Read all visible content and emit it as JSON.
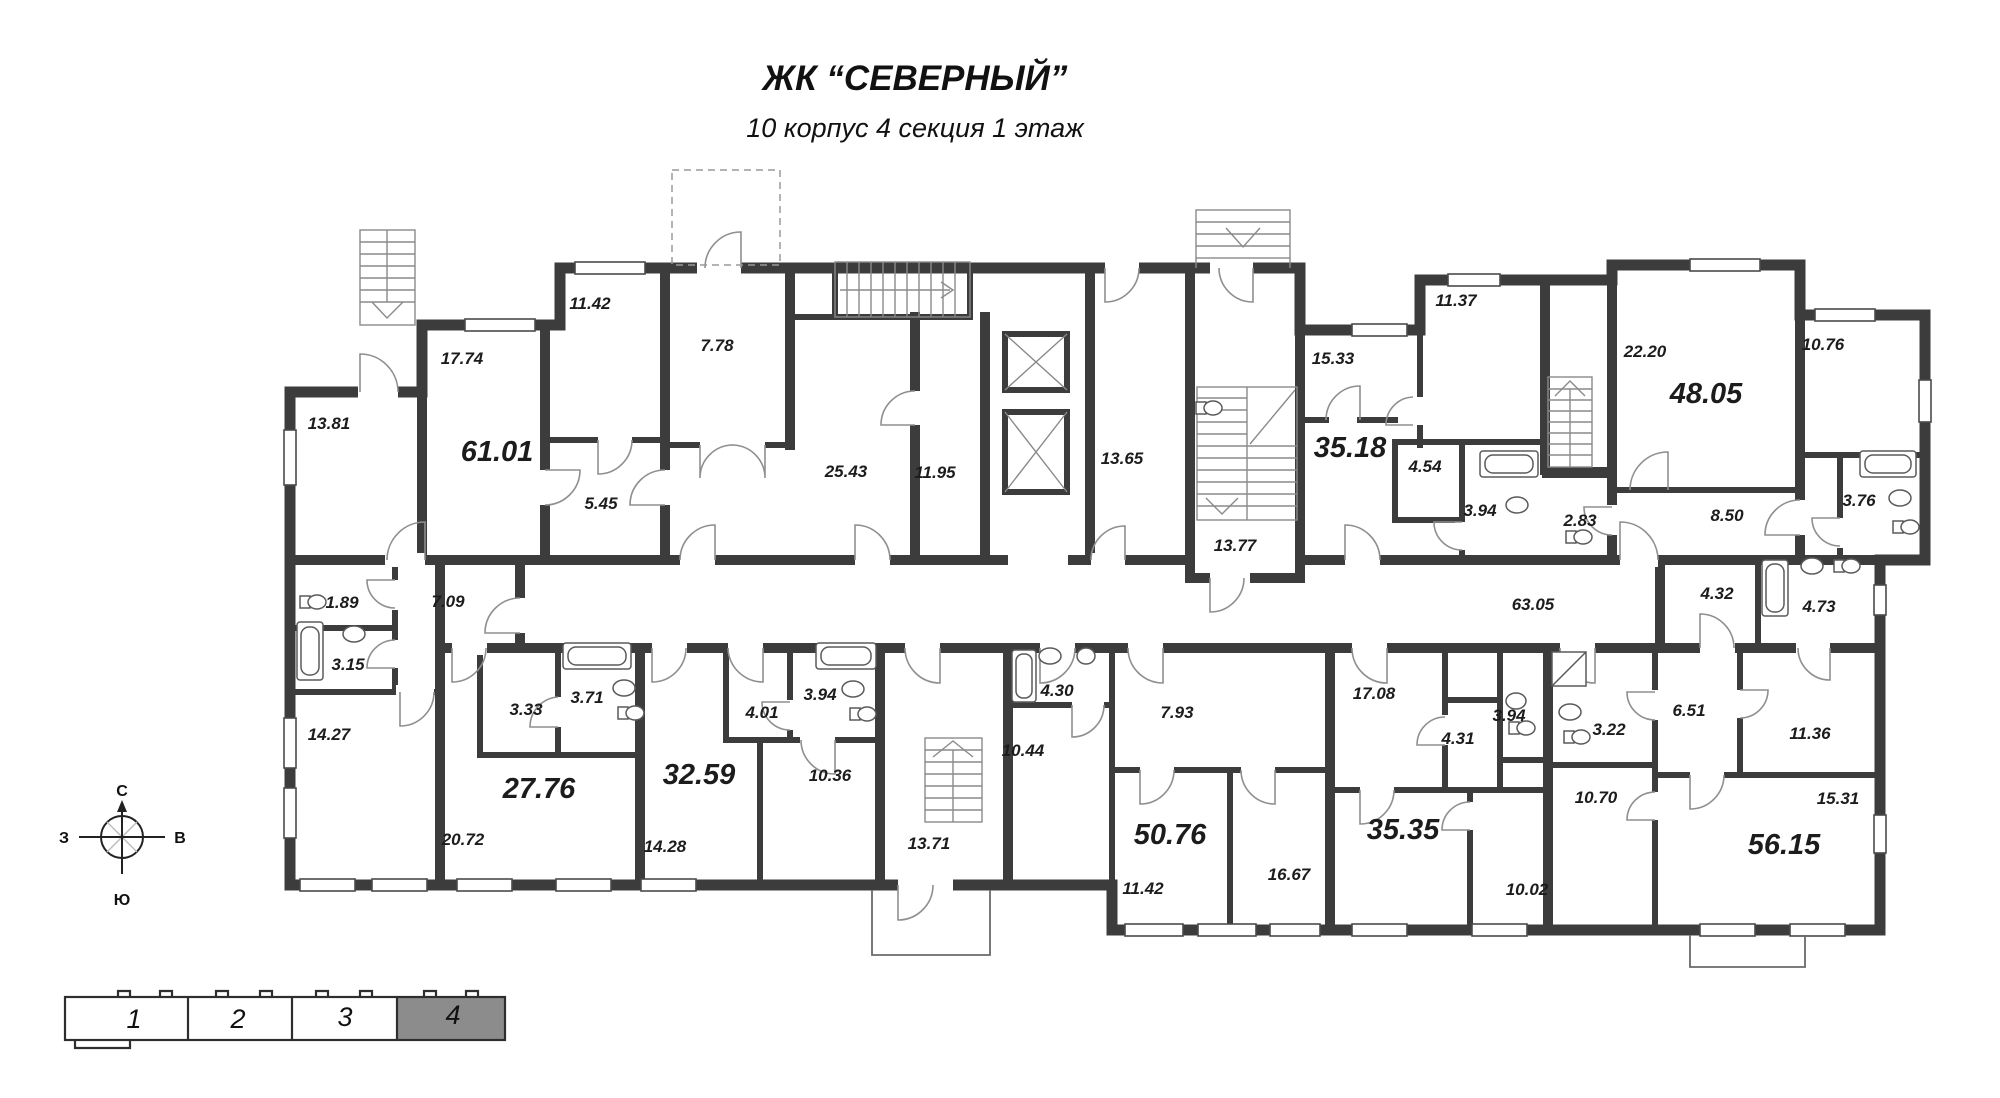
{
  "title": {
    "line1": "ЖК “СЕВЕРНЫЙ”",
    "line2": "10 корпус 4 секция 1 этаж"
  },
  "compass": {
    "north": "С",
    "south": "Ю",
    "west": "З",
    "east": "В"
  },
  "key_plan": {
    "sections": [
      {
        "label": "1",
        "highlighted": false
      },
      {
        "label": "2",
        "highlighted": false
      },
      {
        "label": "3",
        "highlighted": false
      },
      {
        "label": "4",
        "highlighted": true
      }
    ]
  },
  "colors": {
    "wall": "#3c3c3c",
    "highlight_section": "#8c8c8c"
  },
  "rooms": [
    {
      "area": "13.81"
    },
    {
      "area": "17.74"
    },
    {
      "area": "61.01"
    },
    {
      "area": "11.42"
    },
    {
      "area": "5.45"
    },
    {
      "area": "7.78"
    },
    {
      "area": "25.43"
    },
    {
      "area": "11.95"
    },
    {
      "area": "13.65"
    },
    {
      "area": "13.77"
    },
    {
      "area": "15.33"
    },
    {
      "area": "35.18"
    },
    {
      "area": "4.54"
    },
    {
      "area": "3.94"
    },
    {
      "area": "2.83"
    },
    {
      "area": "11.37"
    },
    {
      "area": "22.20"
    },
    {
      "area": "48.05"
    },
    {
      "area": "10.76"
    },
    {
      "area": "8.50"
    },
    {
      "area": "3.76"
    },
    {
      "area": "7.09"
    },
    {
      "area": "63.05"
    },
    {
      "area": "1.89"
    },
    {
      "area": "3.15"
    },
    {
      "area": "14.27"
    },
    {
      "area": "3.33"
    },
    {
      "area": "3.71"
    },
    {
      "area": "27.76"
    },
    {
      "area": "20.72"
    },
    {
      "area": "4.01"
    },
    {
      "area": "3.94"
    },
    {
      "area": "32.59"
    },
    {
      "area": "10.36"
    },
    {
      "area": "14.28"
    },
    {
      "area": "13.71"
    },
    {
      "area": "4.30"
    },
    {
      "area": "10.44"
    },
    {
      "area": "7.93"
    },
    {
      "area": "50.76"
    },
    {
      "area": "11.42"
    },
    {
      "area": "16.67"
    },
    {
      "area": "17.08"
    },
    {
      "area": "4.31"
    },
    {
      "area": "3.94"
    },
    {
      "area": "35.35"
    },
    {
      "area": "10.02"
    },
    {
      "area": "3.22"
    },
    {
      "area": "6.51"
    },
    {
      "area": "4.32"
    },
    {
      "area": "4.73"
    },
    {
      "area": "10.70"
    },
    {
      "area": "11.36"
    },
    {
      "area": "15.31"
    },
    {
      "area": "56.15"
    }
  ]
}
